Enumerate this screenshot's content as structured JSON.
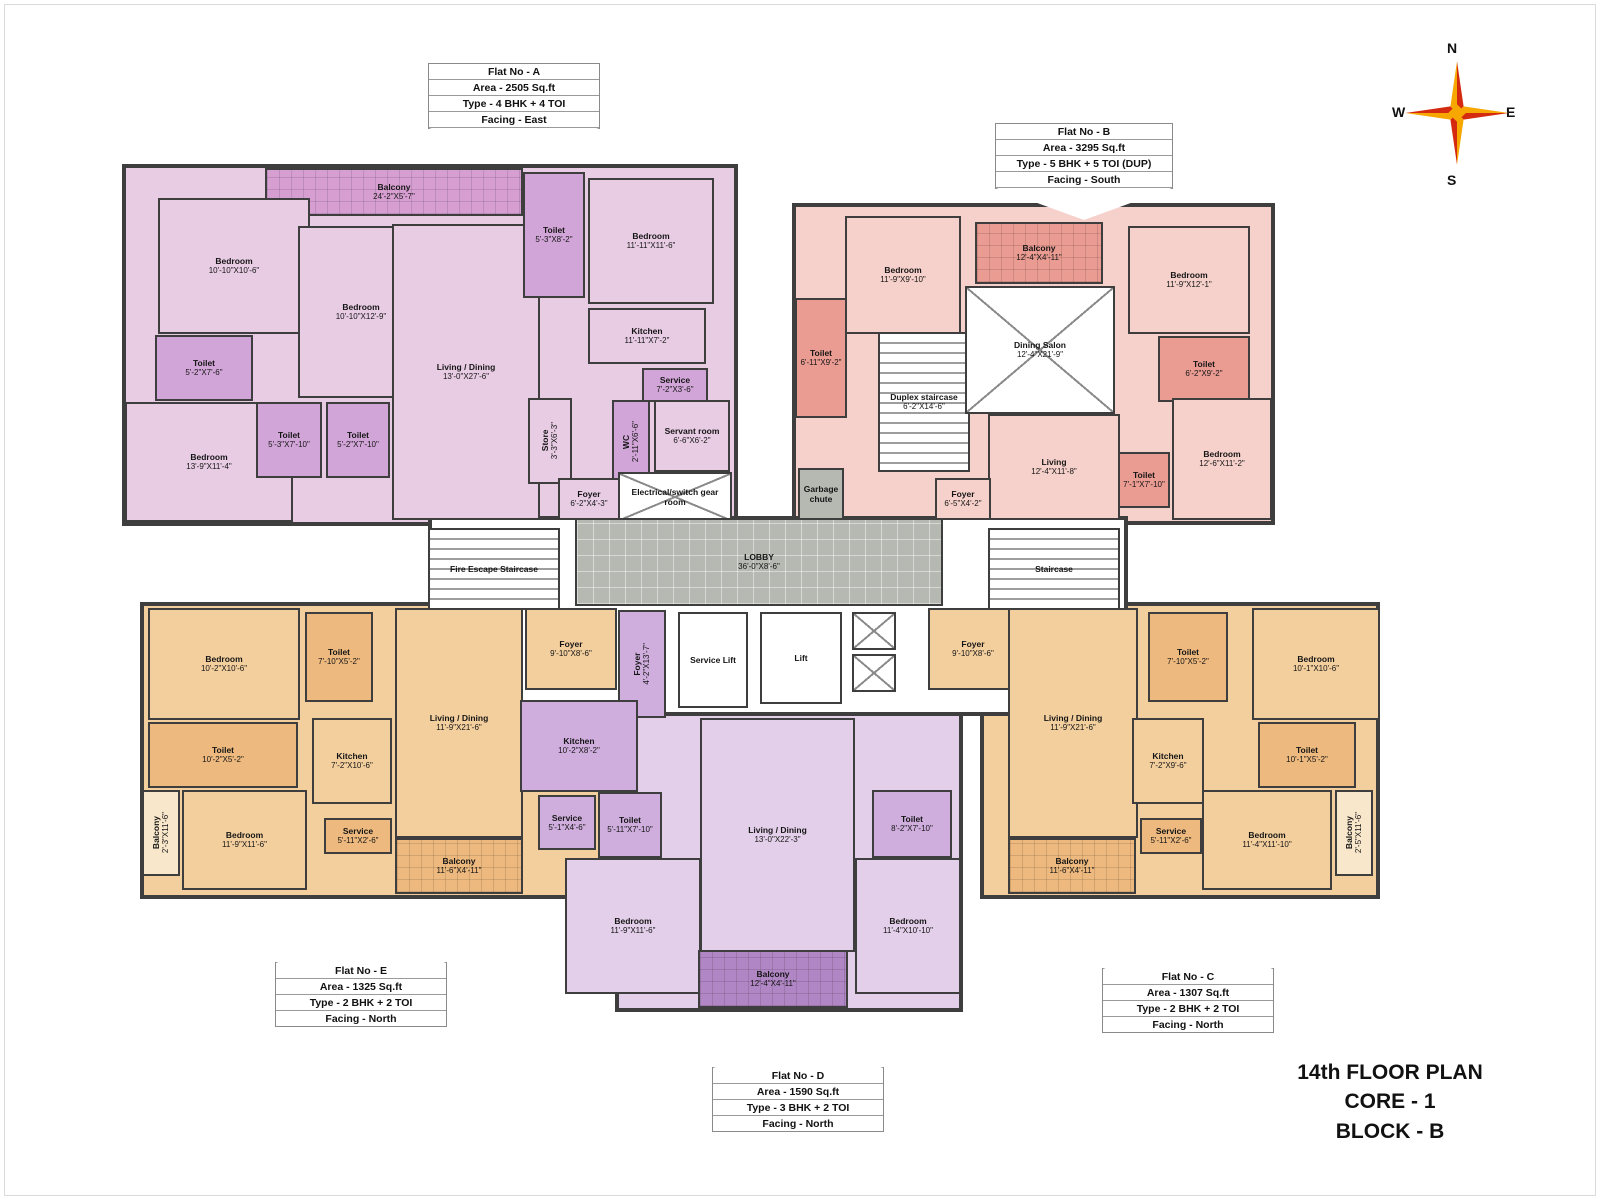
{
  "title": {
    "line1": "14th FLOOR PLAN",
    "line2": "CORE - 1",
    "line3": "BLOCK - B"
  },
  "compass": {
    "n": "N",
    "e": "E",
    "s": "S",
    "w": "W"
  },
  "compass_colors": {
    "red": "#d42a10",
    "yellow": "#f6a800"
  },
  "flats": [
    {
      "id": "A",
      "line1": "Flat  No - A",
      "line2": "Area  - 2505 Sq.ft",
      "line3": "Type -  4 BHK + 4 TOI",
      "line4": "Facing  -  East",
      "pointer": "down"
    },
    {
      "id": "B",
      "line1": "Flat  No - B",
      "line2": "Area  - 3295 Sq.ft",
      "line3": "Type -  5 BHK + 5 TOI (DUP)",
      "line4": "Facing  -  South",
      "pointer": "down"
    },
    {
      "id": "E",
      "line1": "Flat  No - E",
      "line2": "Area  - 1325 Sq.ft",
      "line3": "Type  - 2 BHK + 2 TOI",
      "line4": "Facing   -  North",
      "pointer": "up"
    },
    {
      "id": "D",
      "line1": "Flat  No - D",
      "line2": "Area  - 1590 Sq.ft",
      "line3": "Type  -  3 BHK + 2 TOI",
      "line4": "Facing  -  North",
      "pointer": "up"
    },
    {
      "id": "C",
      "line1": "Flat  No - C",
      "line2": "Area  - 1307 Sq.ft",
      "line3": "Type - 2 BHK + 2 TOI",
      "line4": "Facing  -  North",
      "pointer": "up"
    }
  ],
  "floorplan": {
    "rooms": [
      {
        "zone": true,
        "f": "aBase",
        "x": 122,
        "y": 164,
        "w": 616,
        "h": 362
      },
      {
        "zone": true,
        "f": "bBase",
        "x": 792,
        "y": 203,
        "w": 483,
        "h": 322
      },
      {
        "zone": true,
        "f": "eBase",
        "x": 140,
        "y": 602,
        "w": 483,
        "h": 297
      },
      {
        "zone": true,
        "f": "eBase",
        "x": 980,
        "y": 602,
        "w": 400,
        "h": 297
      },
      {
        "zone": true,
        "f": "dBase",
        "x": 615,
        "y": 606,
        "w": 348,
        "h": 406
      },
      {
        "zone": true,
        "f": "white",
        "x": 428,
        "y": 516,
        "w": 700,
        "h": 200
      },
      {
        "n": "Balcony",
        "d": "24'-2\"X5'-7\"",
        "f": "aDark",
        "p": "cellpat",
        "x": 265,
        "y": 168,
        "w": 258,
        "h": 48
      },
      {
        "n": "Bedroom",
        "d": "10'-10\"X10'-6\"",
        "f": "aBase",
        "x": 158,
        "y": 198,
        "w": 152,
        "h": 136
      },
      {
        "n": "Toilet",
        "d": "5'-2\"X7'-6\"",
        "f": "aMid",
        "x": 155,
        "y": 335,
        "w": 98,
        "h": 66
      },
      {
        "n": "Bedroom",
        "d": "13'-9\"X11'-4\"",
        "f": "aBase",
        "x": 125,
        "y": 402,
        "w": 168,
        "h": 120
      },
      {
        "n": "Toilet",
        "d": "5'-3\"X7'-10\"",
        "f": "aMid",
        "x": 256,
        "y": 402,
        "w": 66,
        "h": 76
      },
      {
        "n": "Toilet",
        "d": "5'-2\"X7'-10\"",
        "f": "aMid",
        "x": 326,
        "y": 402,
        "w": 64,
        "h": 76
      },
      {
        "n": "Bedroom",
        "d": "10'-10\"X12'-9\"",
        "f": "aBase",
        "x": 298,
        "y": 226,
        "w": 126,
        "h": 172
      },
      {
        "n": "Living / Dining",
        "d": "13'-0\"X27'-6\"",
        "f": "aBase",
        "x": 392,
        "y": 224,
        "w": 148,
        "h": 296
      },
      {
        "n": "Toilet",
        "d": "5'-3\"X8'-2\"",
        "f": "aMid",
        "x": 523,
        "y": 172,
        "w": 62,
        "h": 126
      },
      {
        "n": "Bedroom",
        "d": "11'-11\"X11'-6\"",
        "f": "aBase",
        "x": 588,
        "y": 178,
        "w": 126,
        "h": 126
      },
      {
        "n": "Kitchen",
        "d": "11'-11\"X7'-2\"",
        "f": "aBase",
        "x": 588,
        "y": 308,
        "w": 118,
        "h": 56
      },
      {
        "n": "Service",
        "d": "7'-2\"X3'-6\"",
        "f": "aMid",
        "x": 642,
        "y": 368,
        "w": 66,
        "h": 34
      },
      {
        "n": "Store",
        "d": "3'-3\"X6'-3\"",
        "f": "aBase",
        "v": true,
        "x": 528,
        "y": 398,
        "w": 44,
        "h": 86
      },
      {
        "n": "WC",
        "d": "2'-11\"X6'-6\"",
        "f": "aMid",
        "v": true,
        "x": 612,
        "y": 400,
        "w": 38,
        "h": 84
      },
      {
        "n": "Servant room",
        "d": "6'-6\"X6'-2\"",
        "f": "aBase",
        "x": 654,
        "y": 400,
        "w": 76,
        "h": 72
      },
      {
        "n": "Foyer",
        "d": "6'-2\"X4'-3\"",
        "f": "aBase",
        "x": 558,
        "y": 478,
        "w": 62,
        "h": 42
      },
      {
        "n": "Electrical/switch gear room",
        "d": "",
        "f": "white",
        "p": "xpat",
        "x": 618,
        "y": 472,
        "w": 114,
        "h": 50
      },
      {
        "n": "Bedroom",
        "d": "11'-9\"X9'-10\"",
        "f": "bBase",
        "x": 845,
        "y": 216,
        "w": 116,
        "h": 118
      },
      {
        "n": "Toilet",
        "d": "6'-11\"X9'-2\"",
        "f": "bDark",
        "x": 795,
        "y": 298,
        "w": 52,
        "h": 120
      },
      {
        "n": "Duplex staircase",
        "d": "6'-2\"X14'-6\"",
        "f": "white",
        "p": "stairs",
        "x": 878,
        "y": 332,
        "w": 92,
        "h": 140
      },
      {
        "n": "Balcony",
        "d": "12'-4\"X4'-11\"",
        "f": "bDark",
        "p": "cellpat",
        "x": 975,
        "y": 222,
        "w": 128,
        "h": 62
      },
      {
        "n": "Dining Salon",
        "d": "12'-4\"X21'-9\"",
        "f": "white",
        "p": "xpat",
        "x": 965,
        "y": 286,
        "w": 150,
        "h": 128
      },
      {
        "n": "Bedroom",
        "d": "11'-9\"X12'-1\"",
        "f": "bBase",
        "x": 1128,
        "y": 226,
        "w": 122,
        "h": 108
      },
      {
        "n": "Toilet",
        "d": "6'-2\"X9'-2\"",
        "f": "bDark",
        "x": 1158,
        "y": 336,
        "w": 92,
        "h": 66
      },
      {
        "n": "Bedroom",
        "d": "12'-6\"X11'-2\"",
        "f": "bBase",
        "x": 1172,
        "y": 398,
        "w": 100,
        "h": 122
      },
      {
        "n": "Living",
        "d": "12'-4\"X11'-8\"",
        "f": "bBase",
        "x": 988,
        "y": 414,
        "w": 132,
        "h": 106
      },
      {
        "n": "Toilet",
        "d": "7'-1\"X7'-10\"",
        "f": "bDark",
        "x": 1118,
        "y": 452,
        "w": 52,
        "h": 56
      },
      {
        "n": "Foyer",
        "d": "6'-5\"X4'-2\"",
        "f": "bBase",
        "x": 935,
        "y": 478,
        "w": 56,
        "h": 42
      },
      {
        "n": "Garbage chute",
        "d": "",
        "f": "gray",
        "x": 798,
        "y": 468,
        "w": 46,
        "h": 52
      },
      {
        "n": "LOBBY",
        "d": "36'-0\"X8'-6\"",
        "f": "gray",
        "p": "gridpat",
        "x": 575,
        "y": 518,
        "w": 368,
        "h": 88
      },
      {
        "n": "Fire Escape Staircase",
        "d": "",
        "f": "white",
        "p": "stairs",
        "x": 428,
        "y": 528,
        "w": 132,
        "h": 82
      },
      {
        "n": "Staircase",
        "d": "",
        "f": "white",
        "p": "stairs",
        "x": 988,
        "y": 528,
        "w": 132,
        "h": 82
      },
      {
        "n": "Service Lift",
        "d": "",
        "f": "white",
        "x": 678,
        "y": 612,
        "w": 70,
        "h": 96
      },
      {
        "n": "Lift",
        "d": "",
        "f": "white",
        "x": 760,
        "y": 612,
        "w": 82,
        "h": 92
      },
      {
        "n": "",
        "d": "",
        "f": "white",
        "p": "xpat",
        "x": 852,
        "y": 612,
        "w": 44,
        "h": 38
      },
      {
        "n": "",
        "d": "",
        "f": "white",
        "p": "xpat",
        "x": 852,
        "y": 654,
        "w": 44,
        "h": 38
      },
      {
        "n": "",
        "d": "",
        "f": "white",
        "p": "xpat",
        "x": 1078,
        "y": 612,
        "w": 48,
        "h": 45
      },
      {
        "n": "",
        "d": "",
        "f": "white",
        "p": "xpat",
        "x": 1078,
        "y": 660,
        "w": 48,
        "h": 45
      },
      {
        "n": "Bedroom",
        "d": "10'-2\"X10'-6\"",
        "f": "eBase",
        "x": 148,
        "y": 608,
        "w": 152,
        "h": 112
      },
      {
        "n": "Toilet",
        "d": "7'-10\"X5'-2\"",
        "f": "eMid",
        "x": 305,
        "y": 612,
        "w": 68,
        "h": 90
      },
      {
        "n": "Toilet",
        "d": "10'-2\"X5'-2\"",
        "f": "eMid",
        "x": 148,
        "y": 722,
        "w": 150,
        "h": 66
      },
      {
        "n": "Bedroom",
        "d": "11'-9\"X11'-6\"",
        "f": "eBase",
        "x": 182,
        "y": 790,
        "w": 125,
        "h": 100
      },
      {
        "n": "Balcony",
        "d": "2'-3\"X11'-6\"",
        "f": "eLight",
        "v": true,
        "x": 142,
        "y": 790,
        "w": 38,
        "h": 86
      },
      {
        "n": "Kitchen",
        "d": "7'-2\"X10'-6\"",
        "f": "eBase",
        "x": 312,
        "y": 718,
        "w": 80,
        "h": 86
      },
      {
        "n": "Service",
        "d": "5'-11\"X2'-6\"",
        "f": "eMid",
        "x": 324,
        "y": 818,
        "w": 68,
        "h": 36
      },
      {
        "n": "Living / Dining",
        "d": "11'-9\"X21'-6\"",
        "f": "eBase",
        "x": 395,
        "y": 608,
        "w": 128,
        "h": 230
      },
      {
        "n": "Foyer",
        "d": "9'-10\"X8'-6\"",
        "f": "eBase",
        "x": 525,
        "y": 608,
        "w": 92,
        "h": 82
      },
      {
        "n": "Balcony",
        "d": "11'-6\"X4'-11\"",
        "f": "eMid",
        "p": "cellpat",
        "x": 395,
        "y": 838,
        "w": 128,
        "h": 56
      },
      {
        "n": "Foyer",
        "d": "4'-2\"X13'-7\"",
        "f": "dMid",
        "v": true,
        "x": 618,
        "y": 610,
        "w": 48,
        "h": 108
      },
      {
        "n": "Kitchen",
        "d": "10'-2\"X8'-2\"",
        "f": "dMid",
        "x": 520,
        "y": 700,
        "w": 118,
        "h": 92
      },
      {
        "n": "Service",
        "d": "5'-1\"X4'-6\"",
        "f": "dMid",
        "x": 538,
        "y": 795,
        "w": 58,
        "h": 55
      },
      {
        "n": "Toilet",
        "d": "5'-11\"X7'-10\"",
        "f": "dMid",
        "x": 598,
        "y": 792,
        "w": 64,
        "h": 66
      },
      {
        "n": "Bedroom",
        "d": "11'-9\"X11'-6\"",
        "f": "dBase",
        "x": 565,
        "y": 858,
        "w": 136,
        "h": 136
      },
      {
        "n": "Living / Dining",
        "d": "13'-0\"X22'-3\"",
        "f": "dBase",
        "x": 700,
        "y": 718,
        "w": 155,
        "h": 234
      },
      {
        "n": "Balcony",
        "d": "12'-4\"X4'-11\"",
        "f": "dDark",
        "p": "cellpat",
        "x": 698,
        "y": 950,
        "w": 150,
        "h": 58
      },
      {
        "n": "Toilet",
        "d": "8'-2\"X7'-10\"",
        "f": "dMid",
        "x": 872,
        "y": 790,
        "w": 80,
        "h": 68
      },
      {
        "n": "Bedroom",
        "d": "11'-4\"X10'-10\"",
        "f": "dBase",
        "x": 855,
        "y": 858,
        "w": 106,
        "h": 136
      },
      {
        "n": "Foyer",
        "d": "9'-10\"X8'-6\"",
        "f": "eBase",
        "x": 928,
        "y": 608,
        "w": 90,
        "h": 82
      },
      {
        "n": "Living / Dining",
        "d": "11'-9\"X21'-6\"",
        "f": "eBase",
        "x": 1008,
        "y": 608,
        "w": 130,
        "h": 230
      },
      {
        "n": "Toilet",
        "d": "7'-10\"X5'-2\"",
        "f": "eMid",
        "x": 1148,
        "y": 612,
        "w": 80,
        "h": 90
      },
      {
        "n": "Bedroom",
        "d": "10'-1\"X10'-6\"",
        "f": "eBase",
        "x": 1252,
        "y": 608,
        "w": 128,
        "h": 112
      },
      {
        "n": "Toilet",
        "d": "10'-1\"X5'-2\"",
        "f": "eMid",
        "x": 1258,
        "y": 722,
        "w": 98,
        "h": 66
      },
      {
        "n": "Bedroom",
        "d": "11'-4\"X11'-10\"",
        "f": "eBase",
        "x": 1202,
        "y": 790,
        "w": 130,
        "h": 100
      },
      {
        "n": "Balcony",
        "d": "2'-5\"X11'-6\"",
        "f": "eLight",
        "v": true,
        "x": 1335,
        "y": 790,
        "w": 38,
        "h": 86
      },
      {
        "n": "Kitchen",
        "d": "7'-2\"X9'-6\"",
        "f": "eBase",
        "x": 1132,
        "y": 718,
        "w": 72,
        "h": 86
      },
      {
        "n": "Service",
        "d": "5'-11\"X2'-6\"",
        "f": "eMid",
        "x": 1140,
        "y": 818,
        "w": 62,
        "h": 36
      },
      {
        "n": "Balcony",
        "d": "11'-6\"X4'-11\"",
        "f": "eMid",
        "p": "cellpat",
        "x": 1008,
        "y": 838,
        "w": 128,
        "h": 56
      }
    ]
  }
}
